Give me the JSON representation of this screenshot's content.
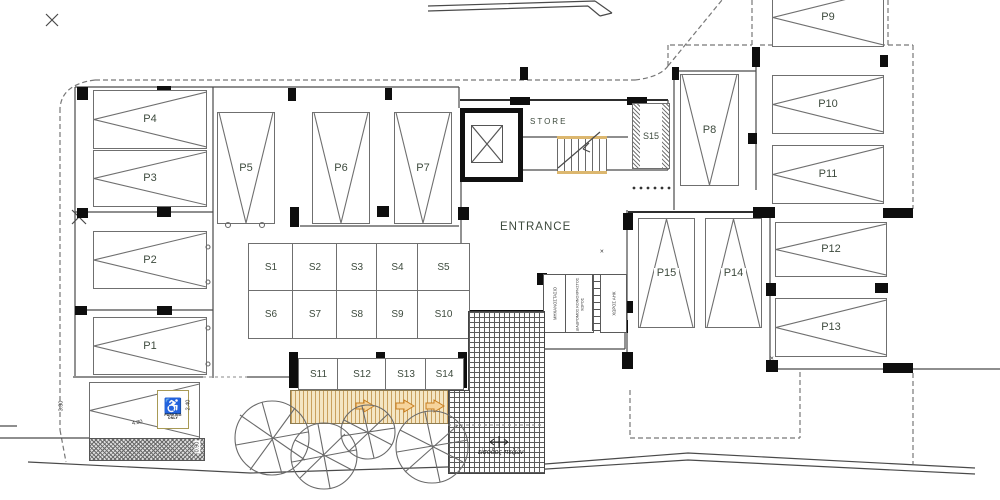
{
  "plan": {
    "parking": {
      "p1": {
        "label": "P1"
      },
      "p2": {
        "label": "P2"
      },
      "p3": {
        "label": "P3"
      },
      "p4": {
        "label": "P4"
      },
      "p5": {
        "label": "P5"
      },
      "p6": {
        "label": "P6"
      },
      "p7": {
        "label": "P7"
      },
      "p8": {
        "label": "P8"
      },
      "p9": {
        "label": "P9"
      },
      "p10": {
        "label": "P10"
      },
      "p11": {
        "label": "P11"
      },
      "p12": {
        "label": "P12"
      },
      "p13": {
        "label": "P13"
      },
      "p14": {
        "label": "P14"
      },
      "p15": {
        "label": "P15"
      }
    },
    "storage": {
      "s1": {
        "label": "S1"
      },
      "s2": {
        "label": "S2"
      },
      "s3": {
        "label": "S3"
      },
      "s4": {
        "label": "S4"
      },
      "s5": {
        "label": "S5"
      },
      "s6": {
        "label": "S6"
      },
      "s7": {
        "label": "S7"
      },
      "s8": {
        "label": "S8"
      },
      "s9": {
        "label": "S9"
      },
      "s10": {
        "label": "S10"
      },
      "s11": {
        "label": "S11"
      },
      "s12": {
        "label": "S12"
      },
      "s13": {
        "label": "S13"
      },
      "s14": {
        "label": "S14"
      },
      "s15": {
        "label": "S15"
      }
    },
    "rooms": {
      "store": "STORE",
      "entrance": "ENTRANCE",
      "machine_room": "ΜΗΧΑΝΟΣΤΑΣΙΟ",
      "common_corridor": "ΔΙΑΔΡΟΜΟΣ ΚΟΙΝΟΧΡΗΣΤΟΣ ΧΩΡΟΣ",
      "utility_room": "ΧΩΡΟΣ ΑΗΚ"
    },
    "texts": {
      "pedestrian_entrance": "είσοδος πεζών"
    },
    "sign": {
      "line1": "PARKING",
      "line2": "ONLY"
    },
    "dimensions": {
      "aisle_depth": "3.30",
      "bay_width": "4.80",
      "bay_height": "2.40",
      "strip": "0.90"
    },
    "icons": {
      "wheelchair_glyph": "♿"
    },
    "colors": {
      "label": "#3d4a3d",
      "deck_bg": "#f4e6c4",
      "deck_stripe": "#c9a05e",
      "arrow": "#d8921f",
      "stair_edge": "#dcb76f",
      "sign_border": "#a89a55",
      "pier": "#0e0e0e"
    }
  }
}
